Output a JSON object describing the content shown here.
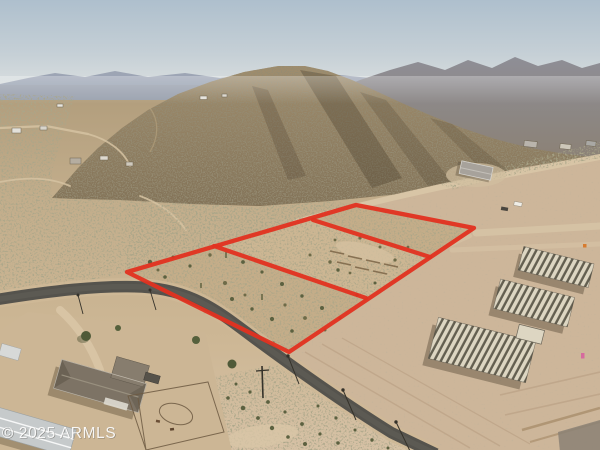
{
  "scene": {
    "type": "aerial-drone-photo",
    "description": "Vacant Sonoran desert land parcel outlined in red at the foot of a desert mountain; graded lots with homes under construction on the right, ranch homestead lower left, paved road crossing diagonally",
    "sky_color": "#aebfcd",
    "desert_color": "#c2ad8b",
    "graded_dirt_color": "#cdb69a",
    "asphalt_color": "#55534d",
    "mountain_color": "#8a7a5e"
  },
  "watermark": {
    "text": "© 2025 ARMLS",
    "color": "#ffffff"
  },
  "boundary": {
    "color": "#e23220",
    "stroke_width": 4.3,
    "outer_points": "127,272 356,205 474,228 289,352",
    "divider1_points": "214,246 366,298",
    "divider2_points": "313,220 430,257"
  }
}
